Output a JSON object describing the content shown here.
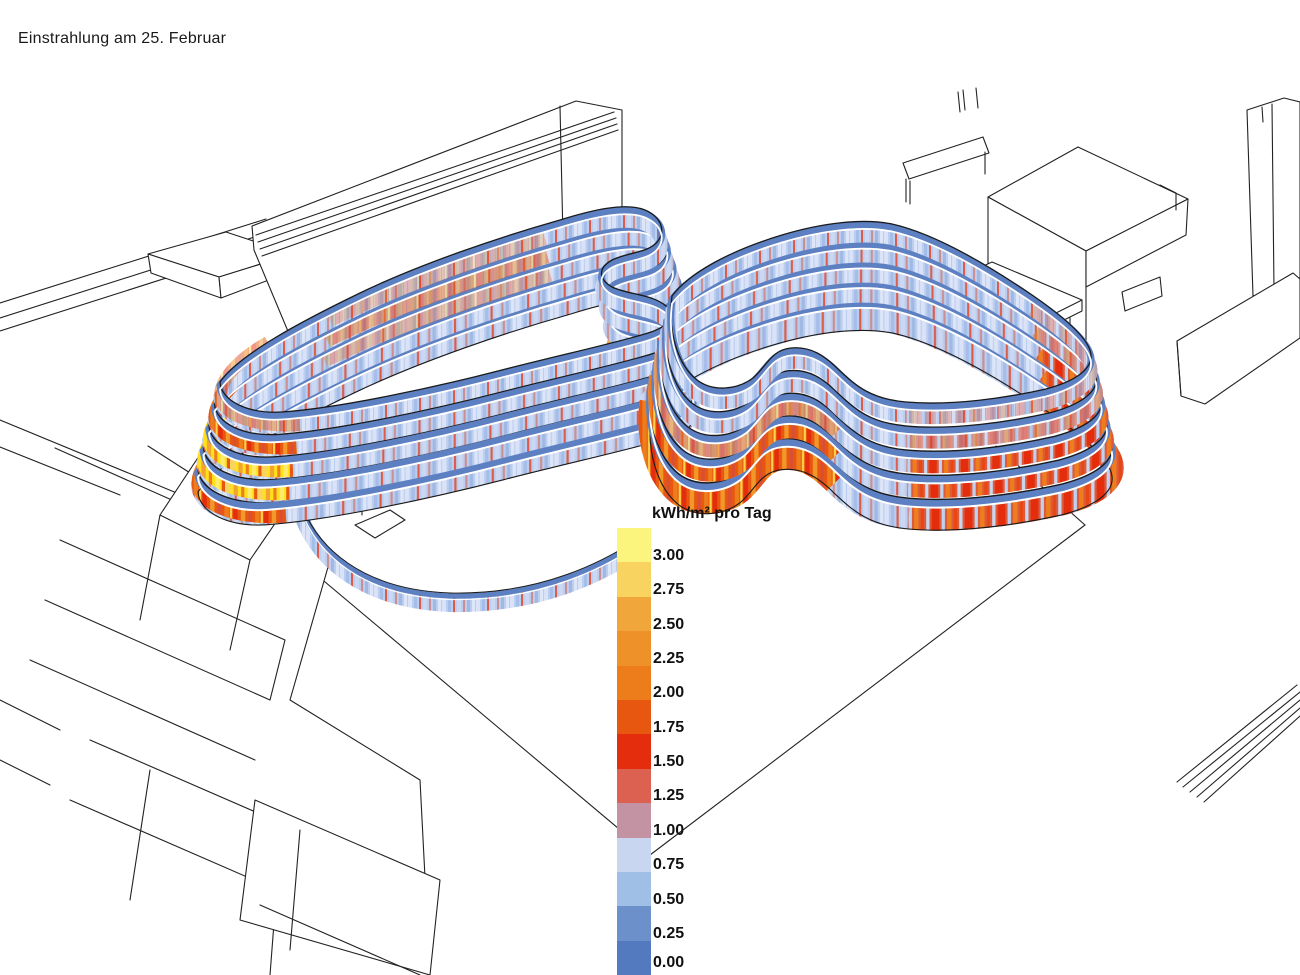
{
  "title": "Einstrahlung am 25. Februar",
  "legend": {
    "header": "kWh/m² pro Tag",
    "entries": [
      {
        "value": "3.00",
        "color": "#FBF57E"
      },
      {
        "value": "2.75",
        "color": "#F8D35F"
      },
      {
        "value": "2.50",
        "color": "#F1A63B"
      },
      {
        "value": "2.25",
        "color": "#EF9129"
      },
      {
        "value": "2.00",
        "color": "#ED7D1B"
      },
      {
        "value": "1.75",
        "color": "#E8570F"
      },
      {
        "value": "1.50",
        "color": "#E42D0C"
      },
      {
        "value": "1.25",
        "color": "#DC6150"
      },
      {
        "value": "1.00",
        "color": "#C392A3"
      },
      {
        "value": "0.75",
        "color": "#C9D6EF"
      },
      {
        "value": "0.50",
        "color": "#A0BFE6"
      },
      {
        "value": "0.25",
        "color": "#6C90CA"
      },
      {
        "value": "0.00",
        "color": "#5379BE"
      }
    ]
  },
  "scene": {
    "colors": {
      "band_top": "#5C80C2",
      "facade_blue": "#BCCEEF",
      "facade_red": "#E42D0C",
      "facade_hot": "#FFE11C",
      "wireframe": "#222222",
      "background": "#FFFFFF"
    }
  }
}
